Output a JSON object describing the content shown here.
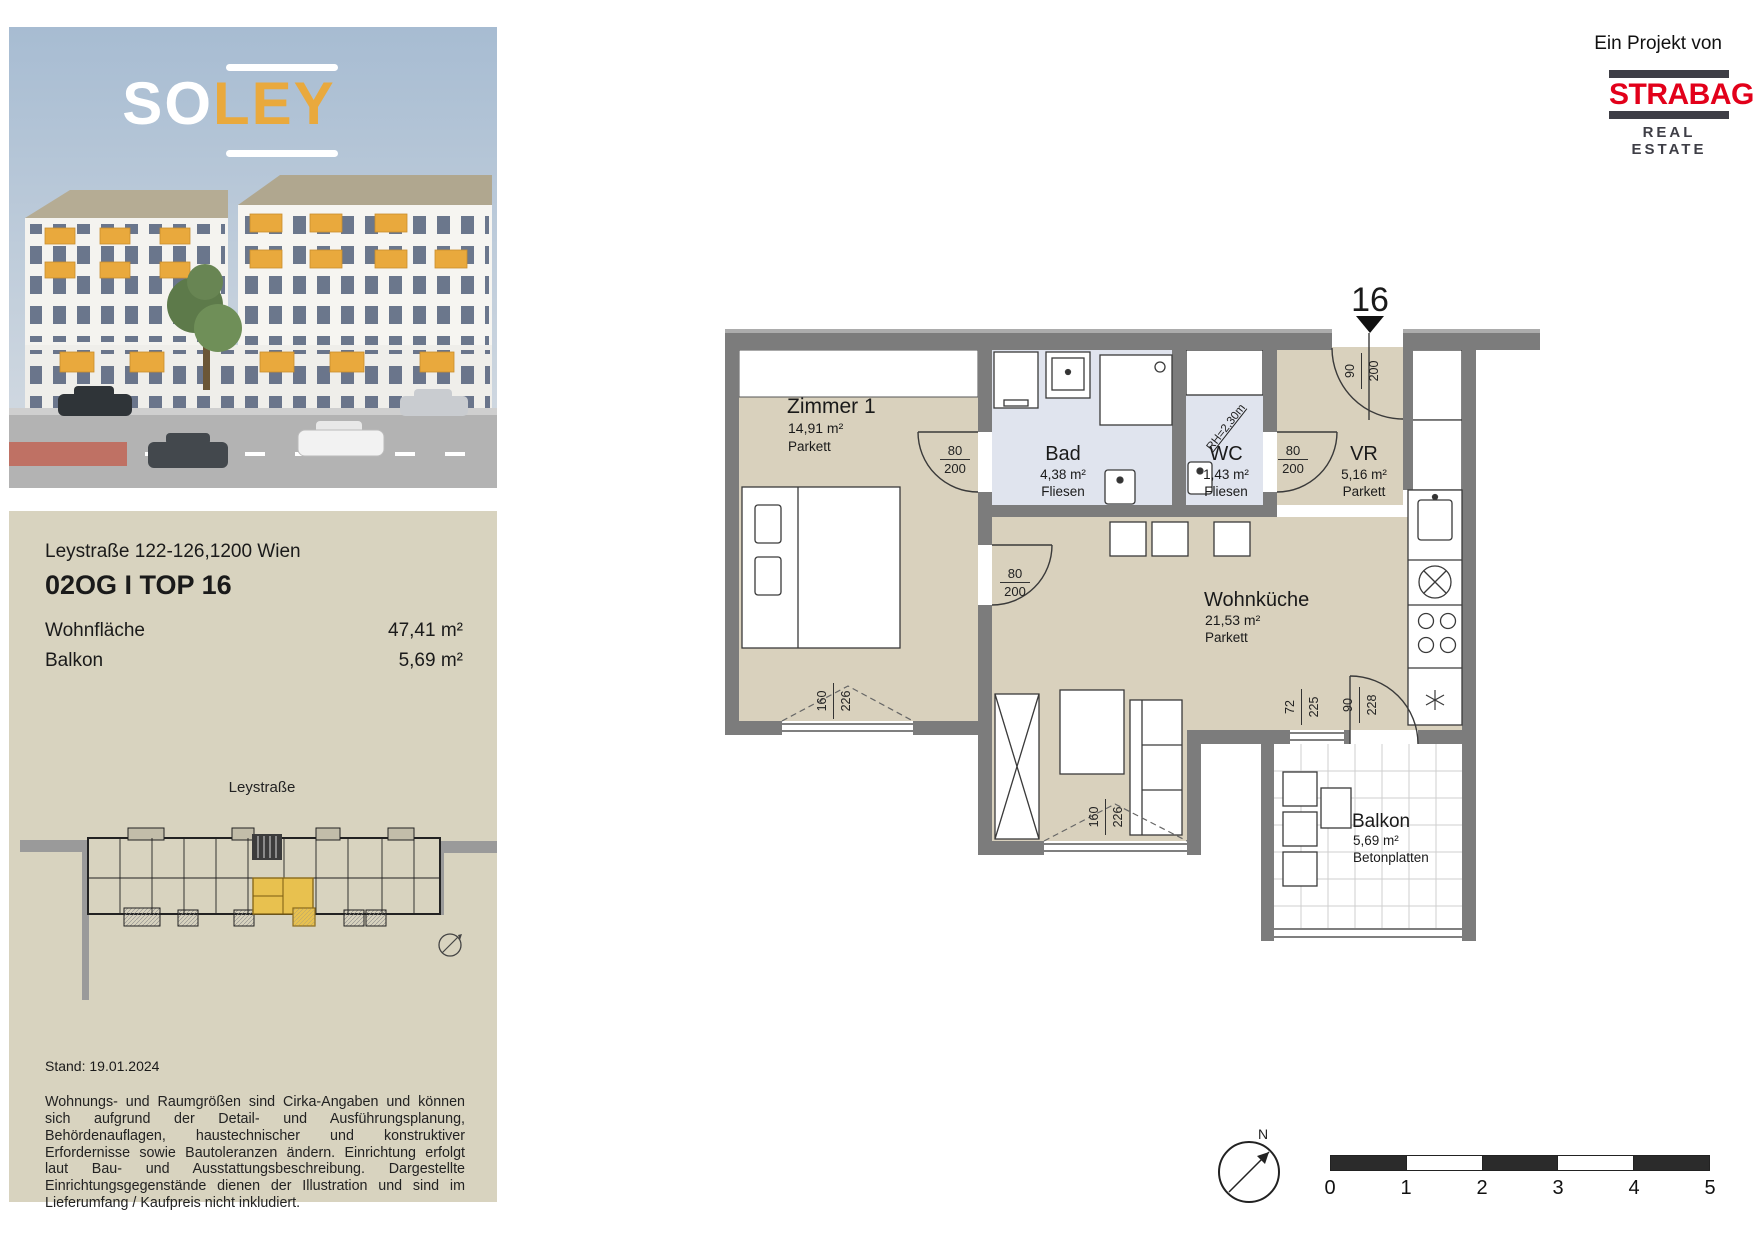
{
  "branding": {
    "logo": {
      "part1": "SO",
      "part2": "LEY"
    },
    "project_credit": "Ein Projekt von",
    "developer": "STRABAG",
    "developer_sub": "REAL ESTATE"
  },
  "info_panel": {
    "address": "Leystraße 122-126,1200 Wien",
    "unit_title": "02OG I TOP 16",
    "metrics": [
      {
        "label": "Wohnfläche",
        "value": "47,41 m²"
      },
      {
        "label": "Balkon",
        "value": "5,69 m²"
      }
    ],
    "sitemap_street": "Leystraße",
    "date_note": "Stand: 19.01.2024",
    "disclaimer": "Wohnungs- und Raumgrößen sind Cirka-Angaben und können sich aufgrund der Detail- und Ausführungsplanung, Behördenauflagen, haustechnischer und konstruktiver Erfordernisse sowie Bautoleranzen ändern. Einrichtung erfolgt laut Bau- und Ausstattungsbeschreibung. Dargestellte Einrichtungsgegenstände dienen der Illustration und sind im Lieferumfang / Kaufpreis nicht inkludiert."
  },
  "floorplan": {
    "unit_number": "16",
    "ceiling_note": "RH=2,30m",
    "north_label": "N",
    "rooms": [
      {
        "name": "Zimmer 1",
        "area": "14,91 m²",
        "floor": "Parkett"
      },
      {
        "name": "Bad",
        "area": "4,38 m²",
        "floor": "Fliesen"
      },
      {
        "name": "WC",
        "area": "1,43 m²",
        "floor": "Fliesen"
      },
      {
        "name": "VR",
        "area": "5,16 m²",
        "floor": "Parkett"
      },
      {
        "name": "Wohnküche",
        "area": "21,53 m²",
        "floor": "Parkett"
      },
      {
        "name": "Balkon",
        "area": "5,69 m²",
        "floor": "Betonplatten"
      }
    ],
    "door_dims": {
      "zimmer_bad": {
        "w": "80",
        "h": "200"
      },
      "wohnkueche_zimmer": {
        "w": "80",
        "h": "200"
      },
      "wc": {
        "w": "80",
        "h": "200"
      },
      "entrance": {
        "w": "90",
        "h": "200"
      }
    },
    "window_dims": {
      "zimmer": {
        "w": "160",
        "h": "226"
      },
      "wohnkueche": {
        "w": "160",
        "h": "226"
      },
      "balkon_fenster": {
        "w": "72",
        "h": "225"
      },
      "balkon_tuer": {
        "w": "90",
        "h": "228"
      }
    },
    "scale_bar": {
      "labels": [
        "0",
        "1",
        "2",
        "3",
        "4",
        "5"
      ]
    }
  },
  "colors": {
    "accent_orange": "#E9A93D",
    "strabag_red": "#E2001A",
    "panel_beige": "#D8D3BF",
    "floor_beige": "#D9D1BD",
    "wet_room_blue": "#E0E4EE",
    "wall_gray": "#7C7C7C",
    "unit_highlight": "#E8C14F"
  }
}
